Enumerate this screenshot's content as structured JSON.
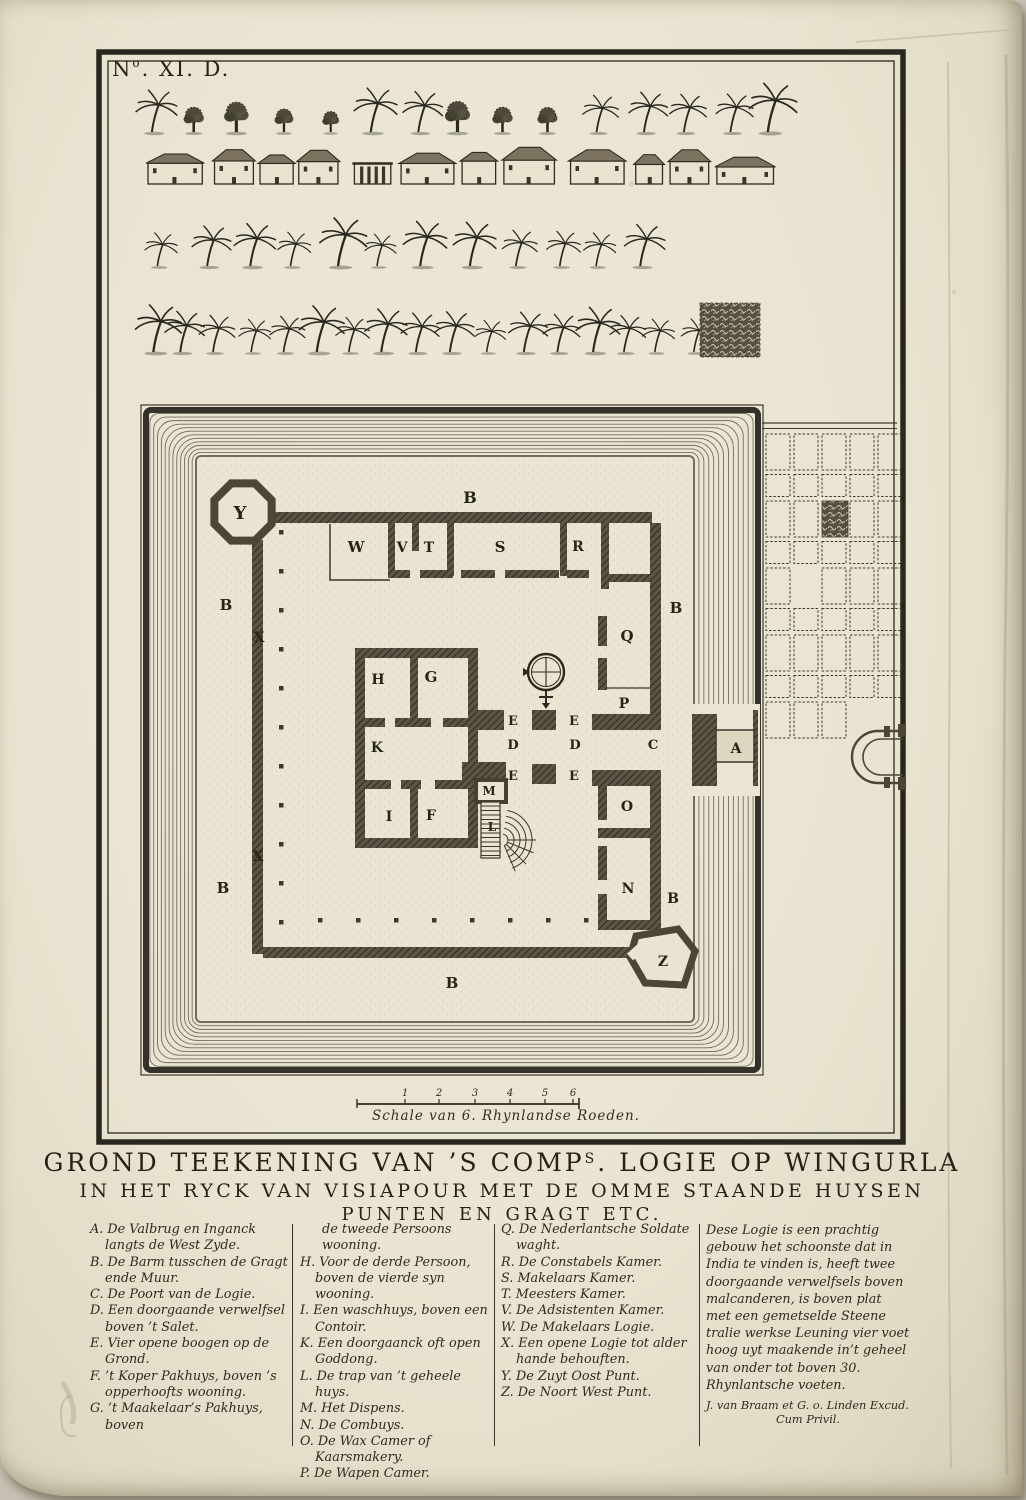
{
  "plate_number": {
    "prefix": "N",
    "sup": "o",
    "suffix": ". XI. D."
  },
  "title": {
    "line1_prefix": "GROND TEEKENING VAN ’S COMP",
    "line1_sup": "S",
    "line1_suffix": ". LOGIE OP WINGURLA",
    "line2": "IN HET RYCK VAN VISIAPOUR MET DE OMME STAANDE HUYSEN",
    "line3": "PUNTEN EN GRAGT ETC."
  },
  "scale": {
    "caption": "Schale van 6. Rhynlandse Roeden.",
    "ticks": [
      "1",
      "2",
      "3",
      "4",
      "5",
      "6"
    ]
  },
  "map": {
    "letters": [
      {
        "ch": "B",
        "x": 470,
        "y": 503,
        "s": 16
      },
      {
        "ch": "Y",
        "x": 240,
        "y": 519,
        "s": 18
      },
      {
        "ch": "W",
        "x": 356,
        "y": 552,
        "s": 15
      },
      {
        "ch": "V",
        "x": 402,
        "y": 552,
        "s": 14
      },
      {
        "ch": "T",
        "x": 429,
        "y": 552,
        "s": 14
      },
      {
        "ch": "S",
        "x": 500,
        "y": 552,
        "s": 15
      },
      {
        "ch": "R",
        "x": 578,
        "y": 551,
        "s": 14
      },
      {
        "ch": "B",
        "x": 226,
        "y": 610,
        "s": 15
      },
      {
        "ch": "B",
        "x": 676,
        "y": 613,
        "s": 15
      },
      {
        "ch": "X",
        "x": 259,
        "y": 642,
        "s": 14
      },
      {
        "ch": "Q",
        "x": 627,
        "y": 641,
        "s": 15
      },
      {
        "ch": "H",
        "x": 378,
        "y": 684,
        "s": 14
      },
      {
        "ch": "G",
        "x": 431,
        "y": 682,
        "s": 15
      },
      {
        "ch": "P",
        "x": 624,
        "y": 708,
        "s": 14
      },
      {
        "ch": "E",
        "x": 513,
        "y": 725,
        "s": 13
      },
      {
        "ch": "E",
        "x": 574,
        "y": 725,
        "s": 13
      },
      {
        "ch": "D",
        "x": 513,
        "y": 749,
        "s": 13
      },
      {
        "ch": "D",
        "x": 575,
        "y": 749,
        "s": 13
      },
      {
        "ch": "C",
        "x": 653,
        "y": 749,
        "s": 13
      },
      {
        "ch": "A",
        "x": 736,
        "y": 753,
        "s": 14
      },
      {
        "ch": "K",
        "x": 377,
        "y": 752,
        "s": 14
      },
      {
        "ch": "E",
        "x": 513,
        "y": 780,
        "s": 13
      },
      {
        "ch": "E",
        "x": 574,
        "y": 780,
        "s": 13
      },
      {
        "ch": "M",
        "x": 489,
        "y": 795,
        "s": 12
      },
      {
        "ch": "O",
        "x": 627,
        "y": 811,
        "s": 14
      },
      {
        "ch": "I",
        "x": 389,
        "y": 821,
        "s": 14
      },
      {
        "ch": "F",
        "x": 431,
        "y": 820,
        "s": 14
      },
      {
        "ch": "L",
        "x": 492,
        "y": 831,
        "s": 12
      },
      {
        "ch": "X",
        "x": 258,
        "y": 861,
        "s": 14
      },
      {
        "ch": "N",
        "x": 628,
        "y": 893,
        "s": 14
      },
      {
        "ch": "B",
        "x": 223,
        "y": 893,
        "s": 15
      },
      {
        "ch": "B",
        "x": 673,
        "y": 903,
        "s": 14
      },
      {
        "ch": "Z",
        "x": 663,
        "y": 966,
        "s": 14
      },
      {
        "ch": "B",
        "x": 452,
        "y": 988,
        "s": 15
      }
    ]
  },
  "decor_rows": [
    {
      "type": "trees",
      "y": 132,
      "x0": 152,
      "x1": 772,
      "n": 15
    },
    {
      "type": "houses",
      "y": 184,
      "x0": 148,
      "x1": 778,
      "n": 13
    },
    {
      "type": "palms",
      "y": 266,
      "x0": 158,
      "x1": 645,
      "n": 12
    },
    {
      "type": "palms",
      "y": 352,
      "x0": 150,
      "x1": 690,
      "n": 17
    },
    {
      "type": "grove",
      "x": 700,
      "y": 303,
      "w": 60,
      "h": 54
    }
  ],
  "legend": {
    "columns": [
      {
        "entries": [
          [
            "A.",
            "De Valbrug en Inganck langts de West Zyde."
          ],
          [
            "B.",
            "De Barm tusschen de Gragt ende Muur."
          ],
          [
            "C.",
            "De Poort van de Logie."
          ],
          [
            "D.",
            "Een doorgaande verwelfsel boven ’t Salet."
          ],
          [
            "E.",
            "Vier opene boogen op de Grond."
          ],
          [
            "F.",
            "’t Koper Pakhuys, boven ’s opperhoofts wooning."
          ],
          [
            "G.",
            "’t Maakelaar’s Pakhuys, boven"
          ]
        ]
      },
      {
        "lead_in": "de tweede Persoons wooning.",
        "entries": [
          [
            "H.",
            "Voor de derde Persoon, boven de vierde syn wooning."
          ],
          [
            "I.",
            "Een waschhuys, boven een Contoir."
          ],
          [
            "K.",
            "Een doorgaanck oft open Goddong."
          ],
          [
            "L.",
            "De trap van ’t geheele huys."
          ],
          [
            "M.",
            "Het Dispens."
          ],
          [
            "N.",
            "De Combuys."
          ],
          [
            "O.",
            "De Wax Camer of Kaarsmakery."
          ],
          [
            "P.",
            "De Wapen Camer."
          ]
        ]
      },
      {
        "entries": [
          [
            "Q.",
            "De Nederlantsche Soldate waght."
          ],
          [
            "R.",
            "De Constabels Kamer."
          ],
          [
            "S.",
            "Makelaars Kamer."
          ],
          [
            "T.",
            "Meesters Kamer."
          ],
          [
            "V.",
            "De Adsistenten Kamer."
          ],
          [
            "W.",
            "De Makelaars Logie."
          ],
          [
            "X.",
            "Een opene Logie tot alder hande behouften."
          ],
          [
            "Y.",
            "De Zuyt Oost Punt."
          ],
          [
            "Z.",
            "De Noort West Punt."
          ]
        ]
      },
      {
        "paragraph": "Dese Logie is een prachtig gebouw het schoonste dat in India te vinden is, heeft twee doorgaande verwelfsels boven malcanderen, is boven plat met een gemetselde Steene tralie werkse Leuning vier voet hoog uyt maakende in’t geheel van onder tot boven 30. Rhynlantsche voeten.",
        "imprint1": "J. van Braam et G. o. Linden Excud.",
        "imprint2": "Cum Privil."
      }
    ]
  },
  "colors": {
    "ink": "#2b2720",
    "wall": "#4c4636",
    "paper": "#e9e4d1",
    "berm": "#eae5d3",
    "moat_line": "#5d5746"
  }
}
